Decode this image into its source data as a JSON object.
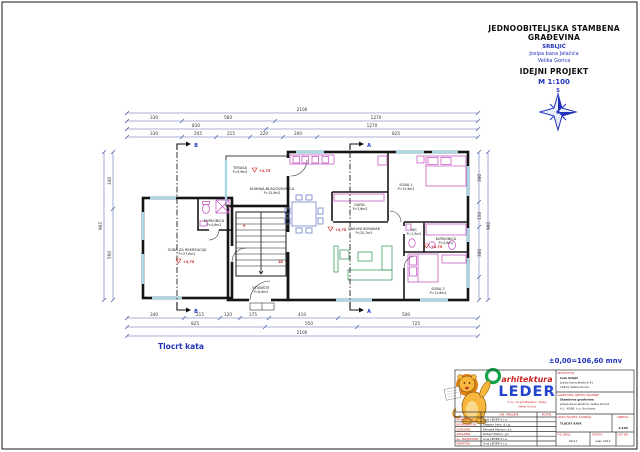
{
  "header": {
    "line1": "JEDNOOBITELJSKA STAMBENA",
    "line2": "GRAĐEVINA",
    "client": "SRBLJIĆ",
    "street": "Josipa bana Jelačića",
    "city": "Velika Gorica",
    "project": "IDEJNI PROJEKT",
    "scale": "M 1:100",
    "compass": "S"
  },
  "caption": "Tlocrt kata",
  "datum_note": "±0,00=106,60 mnv",
  "rooms": {
    "terasa": {
      "name": "TERASA",
      "area": "P=9,9m2"
    },
    "kupaonica1": {
      "name": "KUPAONICA",
      "area": "P=4,6m2"
    },
    "rekreacija": {
      "name": "SOBA ZA REKREACIJU",
      "area": "P=27,6m2"
    },
    "stubiste": {
      "name": "STUBIŠTE",
      "area": "P=6,6m2"
    },
    "kuhinja": {
      "name": "KUHINJA-BLAGOVAONICA",
      "area": "P=15,9m2"
    },
    "gard": {
      "name": "GARD.",
      "area": "P=3,6m2"
    },
    "wc": {
      "name": "WC",
      "area": "P=1,5m2"
    },
    "dnevni": {
      "name": "DNEVNI BORAVAK",
      "area": "P=20,7m2"
    },
    "soba1": {
      "name": "SOBA 1",
      "area": "P=15,9m2"
    },
    "kupaonica2": {
      "name": "KUPAONICA",
      "area": "P=4,6m2"
    },
    "soba2": {
      "name": "SOBA 2",
      "area": "P=11,6m2"
    }
  },
  "levels": {
    "terasa": "+2,75",
    "rekreacija": "+2,75",
    "dnevni": "+2,75",
    "kupaonica2": "+2,75"
  },
  "stairs": {
    "num1": "9",
    "num2": "18"
  },
  "sections": {
    "a": "A",
    "b": "B"
  },
  "dims": {
    "top1": "2100",
    "top2": [
      "330",
      "560",
      "1270"
    ],
    "top3": [
      "830",
      "1270"
    ],
    "top4": [
      "330",
      "205",
      "215",
      "220",
      "200",
      "825"
    ],
    "bottom1": [
      "340",
      "215",
      "120",
      "175",
      "410",
      "500"
    ],
    "bottom2": [
      "825",
      "550",
      "725"
    ],
    "bottom3": "2100",
    "left_total": "905",
    "left_segs": [
      "340",
      "560"
    ],
    "right_total": "900",
    "right_segs": [
      "300",
      "150",
      "300"
    ]
  },
  "brand": {
    "tagline": "arhitektura",
    "name": "LEDER",
    "sub1": "d.o.o. za graditeljstvo i dizajn",
    "sub2": "Velika Gorica"
  },
  "titleblock": {
    "investor_label": "INVESTITOR:",
    "investor": [
      "Ivan Srbljić",
      "Josipa bana Jelačića 91",
      "10410 Velika Gorica"
    ],
    "gradnja_label": "GRAĐEVINA, MJESTO GRADNJE:",
    "gradnja": [
      "Stambena građevina",
      "Josipa bana Jelačića, Velika Gorica",
      "k.č. 4/568, k.o. Kurilovec"
    ],
    "ime_label": "IME I PREZIME",
    "potpis_label": "POTPIS",
    "rows": [
      {
        "role": "PROJEKTANT",
        "name": "Ivna LEDER d.i.a."
      },
      {
        "role": "KOORDINATOR",
        "name": "Stjepan Leko, d.i.g."
      },
      {
        "role": "SURADNIK",
        "name": "Mihaela Markov, a.t."
      },
      {
        "role": "SURADNIK",
        "name": "Robert Zelton, g.t."
      },
      {
        "role": "GL. PROJEKTANT",
        "name": "Ivna LEDER d.i.a."
      },
      {
        "role": "DIREKTOR",
        "name": "Ivna LEDER d.i.a."
      }
    ],
    "naziv_label": "NAZIV NACRTA, SADRŽAJ:",
    "naziv": "TLOCRT KATA",
    "mjerilo_label": "MJERILO",
    "mjerilo": "1:100",
    "td_label": "T.D. BROJ:",
    "td": "24/11",
    "datum_label": "DATUM:",
    "datum": "rujan 2011.",
    "list_label": "LIST BR."
  },
  "colors": {
    "blue": "#2233bb",
    "red": "#cc2222",
    "magenta": "#c75ec7",
    "green": "#3f9e63",
    "cyan": "#a9d7e8",
    "wall": "#151515",
    "dim": "#5566aa"
  }
}
